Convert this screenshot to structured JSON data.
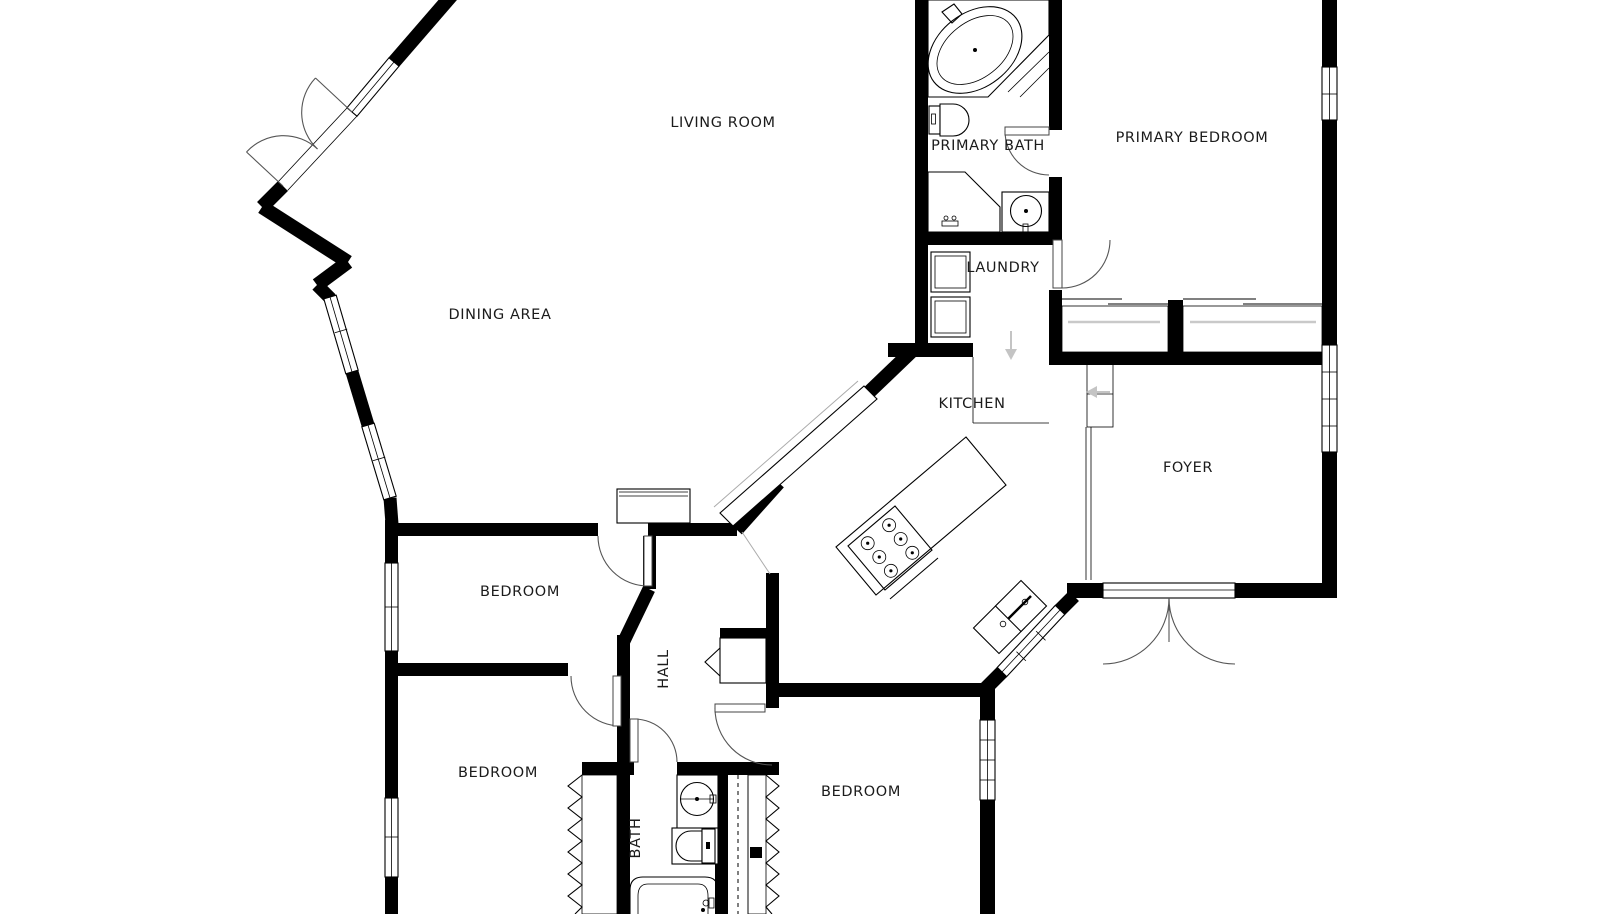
{
  "page": {
    "title": "Floor plan",
    "type": "architectural-floor-plan"
  },
  "colors": {
    "background": "#ffffff",
    "walls": "#000000",
    "door_arcs": "#555555",
    "stair_arrows": "#c4c4c4",
    "label_text": "#1b1b1b"
  },
  "rooms": {
    "living_room": "LIVING ROOM",
    "dining_area": "DINING AREA",
    "primary_bath": "PRIMARY BATH",
    "primary_bedroom": "PRIMARY BEDROOM",
    "laundry": "LAUNDRY",
    "kitchen": "KITCHEN",
    "foyer": "FOYER",
    "bedroom_upper_left": "BEDROOM",
    "hall": "HALL",
    "bedroom_lower_left": "BEDROOM",
    "bath": "BATH",
    "bedroom_lower_right": "BEDROOM"
  },
  "fixtures": [
    "corner-tub",
    "toilet",
    "vanity",
    "vanity-sink",
    "washer",
    "dryer",
    "kitchen-island-cooktop",
    "double-kitchen-sink",
    "bar-counter",
    "pedestal-sink",
    "bathtub",
    "entry-double-door",
    "stairs-down-arrow",
    "stairs-left-arrow",
    "sliding-closet-doors",
    "accordion-closet-doors"
  ]
}
